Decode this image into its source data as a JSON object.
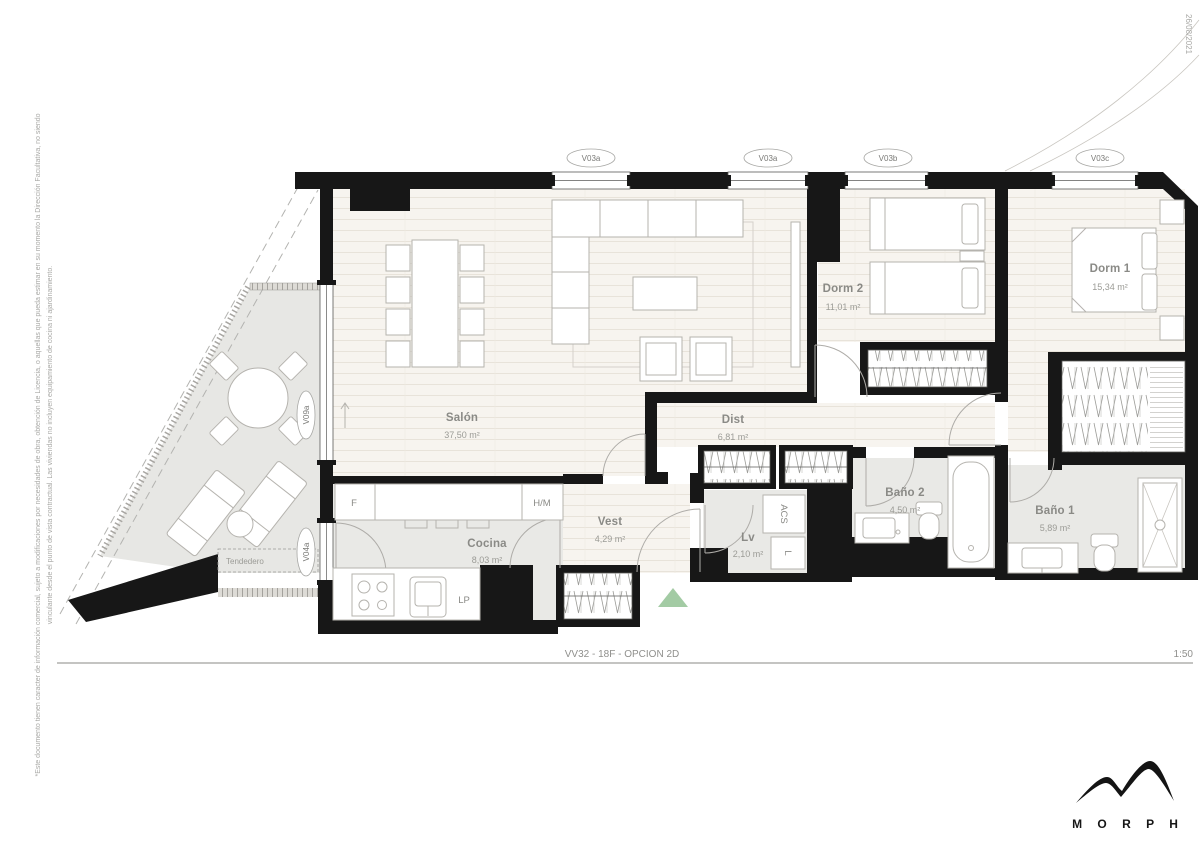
{
  "document": {
    "date": "26/08/2021",
    "disclaimer_line1": "*Este documento tienen caracter de información comercial, sujeto a modificaciones por necesidades de obra, obtención de Licencia, o aquellas que pueda estimar en su momento la Dirección Facultativa, no siendo",
    "disclaimer_line2": "vinculante desde el punto de vista contractual. Las viviendas no incluyen equipamiento de cocina ni ajardinamiento.",
    "title": "VV32 - 18F - OPCION 2D",
    "scale": "1:50",
    "brand": "M O R P H"
  },
  "rooms": {
    "salon": {
      "name": "Salón",
      "area": "37,50 m²"
    },
    "cocina": {
      "name": "Cocina",
      "area": "8,03 m²"
    },
    "vest": {
      "name": "Vest",
      "area": "4,29 m²"
    },
    "dist": {
      "name": "Dist",
      "area": "6,81 m²"
    },
    "dorm2": {
      "name": "Dorm 2",
      "area": "11,01 m²"
    },
    "dorm1": {
      "name": "Dorm 1",
      "area": "15,34 m²"
    },
    "bano2": {
      "name": "Baño 2",
      "area": "4,50 m²"
    },
    "bano1": {
      "name": "Baño 1",
      "area": "5,89 m²"
    },
    "lv": {
      "name": "Lv",
      "area": "2,10 m²"
    },
    "tendedero": {
      "name": "Tendedero"
    }
  },
  "windows": {
    "v03a_1": {
      "label": "V03a"
    },
    "v03a_2": {
      "label": "V03a"
    },
    "v03b": {
      "label": "V03b"
    },
    "v03c": {
      "label": "V03c"
    },
    "v09a": {
      "label": "V09a"
    },
    "v04a": {
      "label": "V04a"
    }
  },
  "equipment": {
    "fridge": "F",
    "hm": "H/M",
    "lp": "LP",
    "acs": "ACS",
    "washer": "L"
  },
  "colors": {
    "wall": "#171717",
    "floor_wood": "#f7f4ef",
    "floor_gray": "#e9e9e6",
    "furniture_line": "#b5b3ae",
    "entry_marker": "#a3cba4",
    "label_text": "#8a8a86"
  }
}
